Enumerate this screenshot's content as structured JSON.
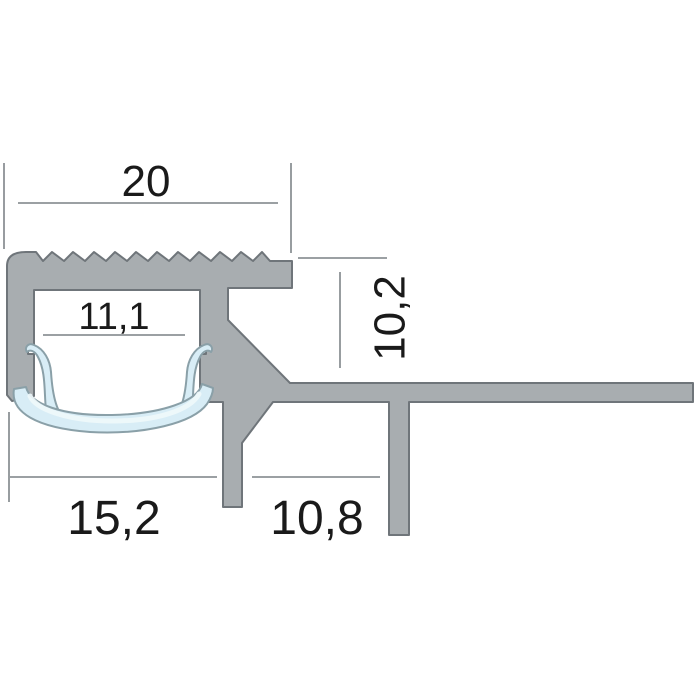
{
  "dimensions": {
    "top_width": {
      "label": "20"
    },
    "channel_width": {
      "label": "11,1"
    },
    "right_height": {
      "label": "10,2"
    },
    "bottom_left_width": {
      "label": "15,2"
    },
    "bottom_right_width": {
      "label": "10,8"
    }
  },
  "colors": {
    "background": "#ffffff",
    "profile_fill": "#a8adb0",
    "profile_outline": "#6f757a",
    "diffuser_fill": "#d8edf6",
    "diffuser_outline": "#8aa0a8",
    "dimension_line": "#8d9296",
    "text": "#1a1a1a"
  }
}
